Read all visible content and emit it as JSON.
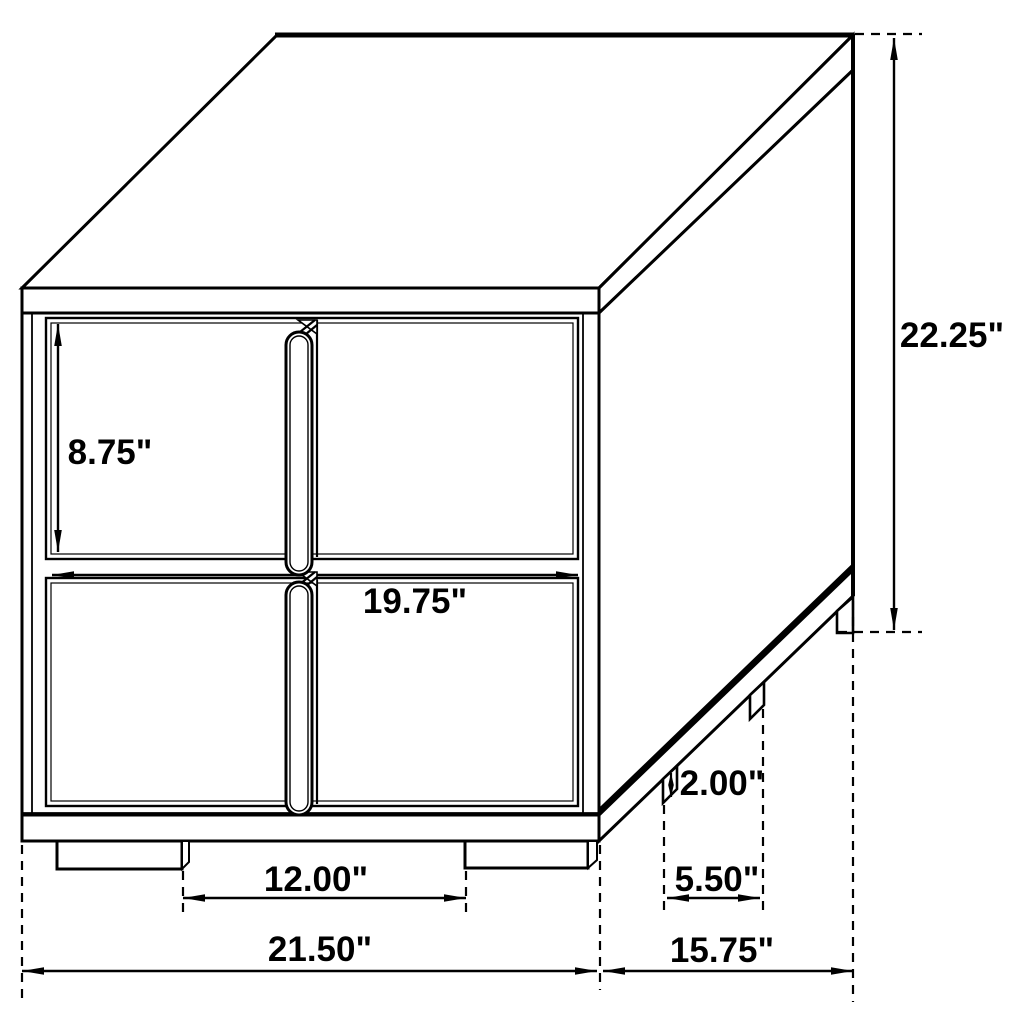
{
  "title": "Two-drawer nightstand dimension drawing",
  "colors": {
    "line": "#000000",
    "background": "#ffffff"
  },
  "labels": {
    "drawer_height": "8.75\"",
    "drawer_width": "19.75\"",
    "overall_height": "22.25\"",
    "leg_height": "2.00\"",
    "side_leg_spacing": "5.50\"",
    "front_leg_spacing": "12.00\"",
    "overall_width": "21.50\"",
    "overall_depth": "15.75\""
  },
  "measurements_inches": {
    "drawer_height": 8.75,
    "drawer_width": 19.75,
    "overall_height": 22.25,
    "leg_height": 2.0,
    "side_leg_spacing": 5.5,
    "front_leg_spacing": 12.0,
    "overall_width": 21.5,
    "overall_depth": 15.75
  }
}
